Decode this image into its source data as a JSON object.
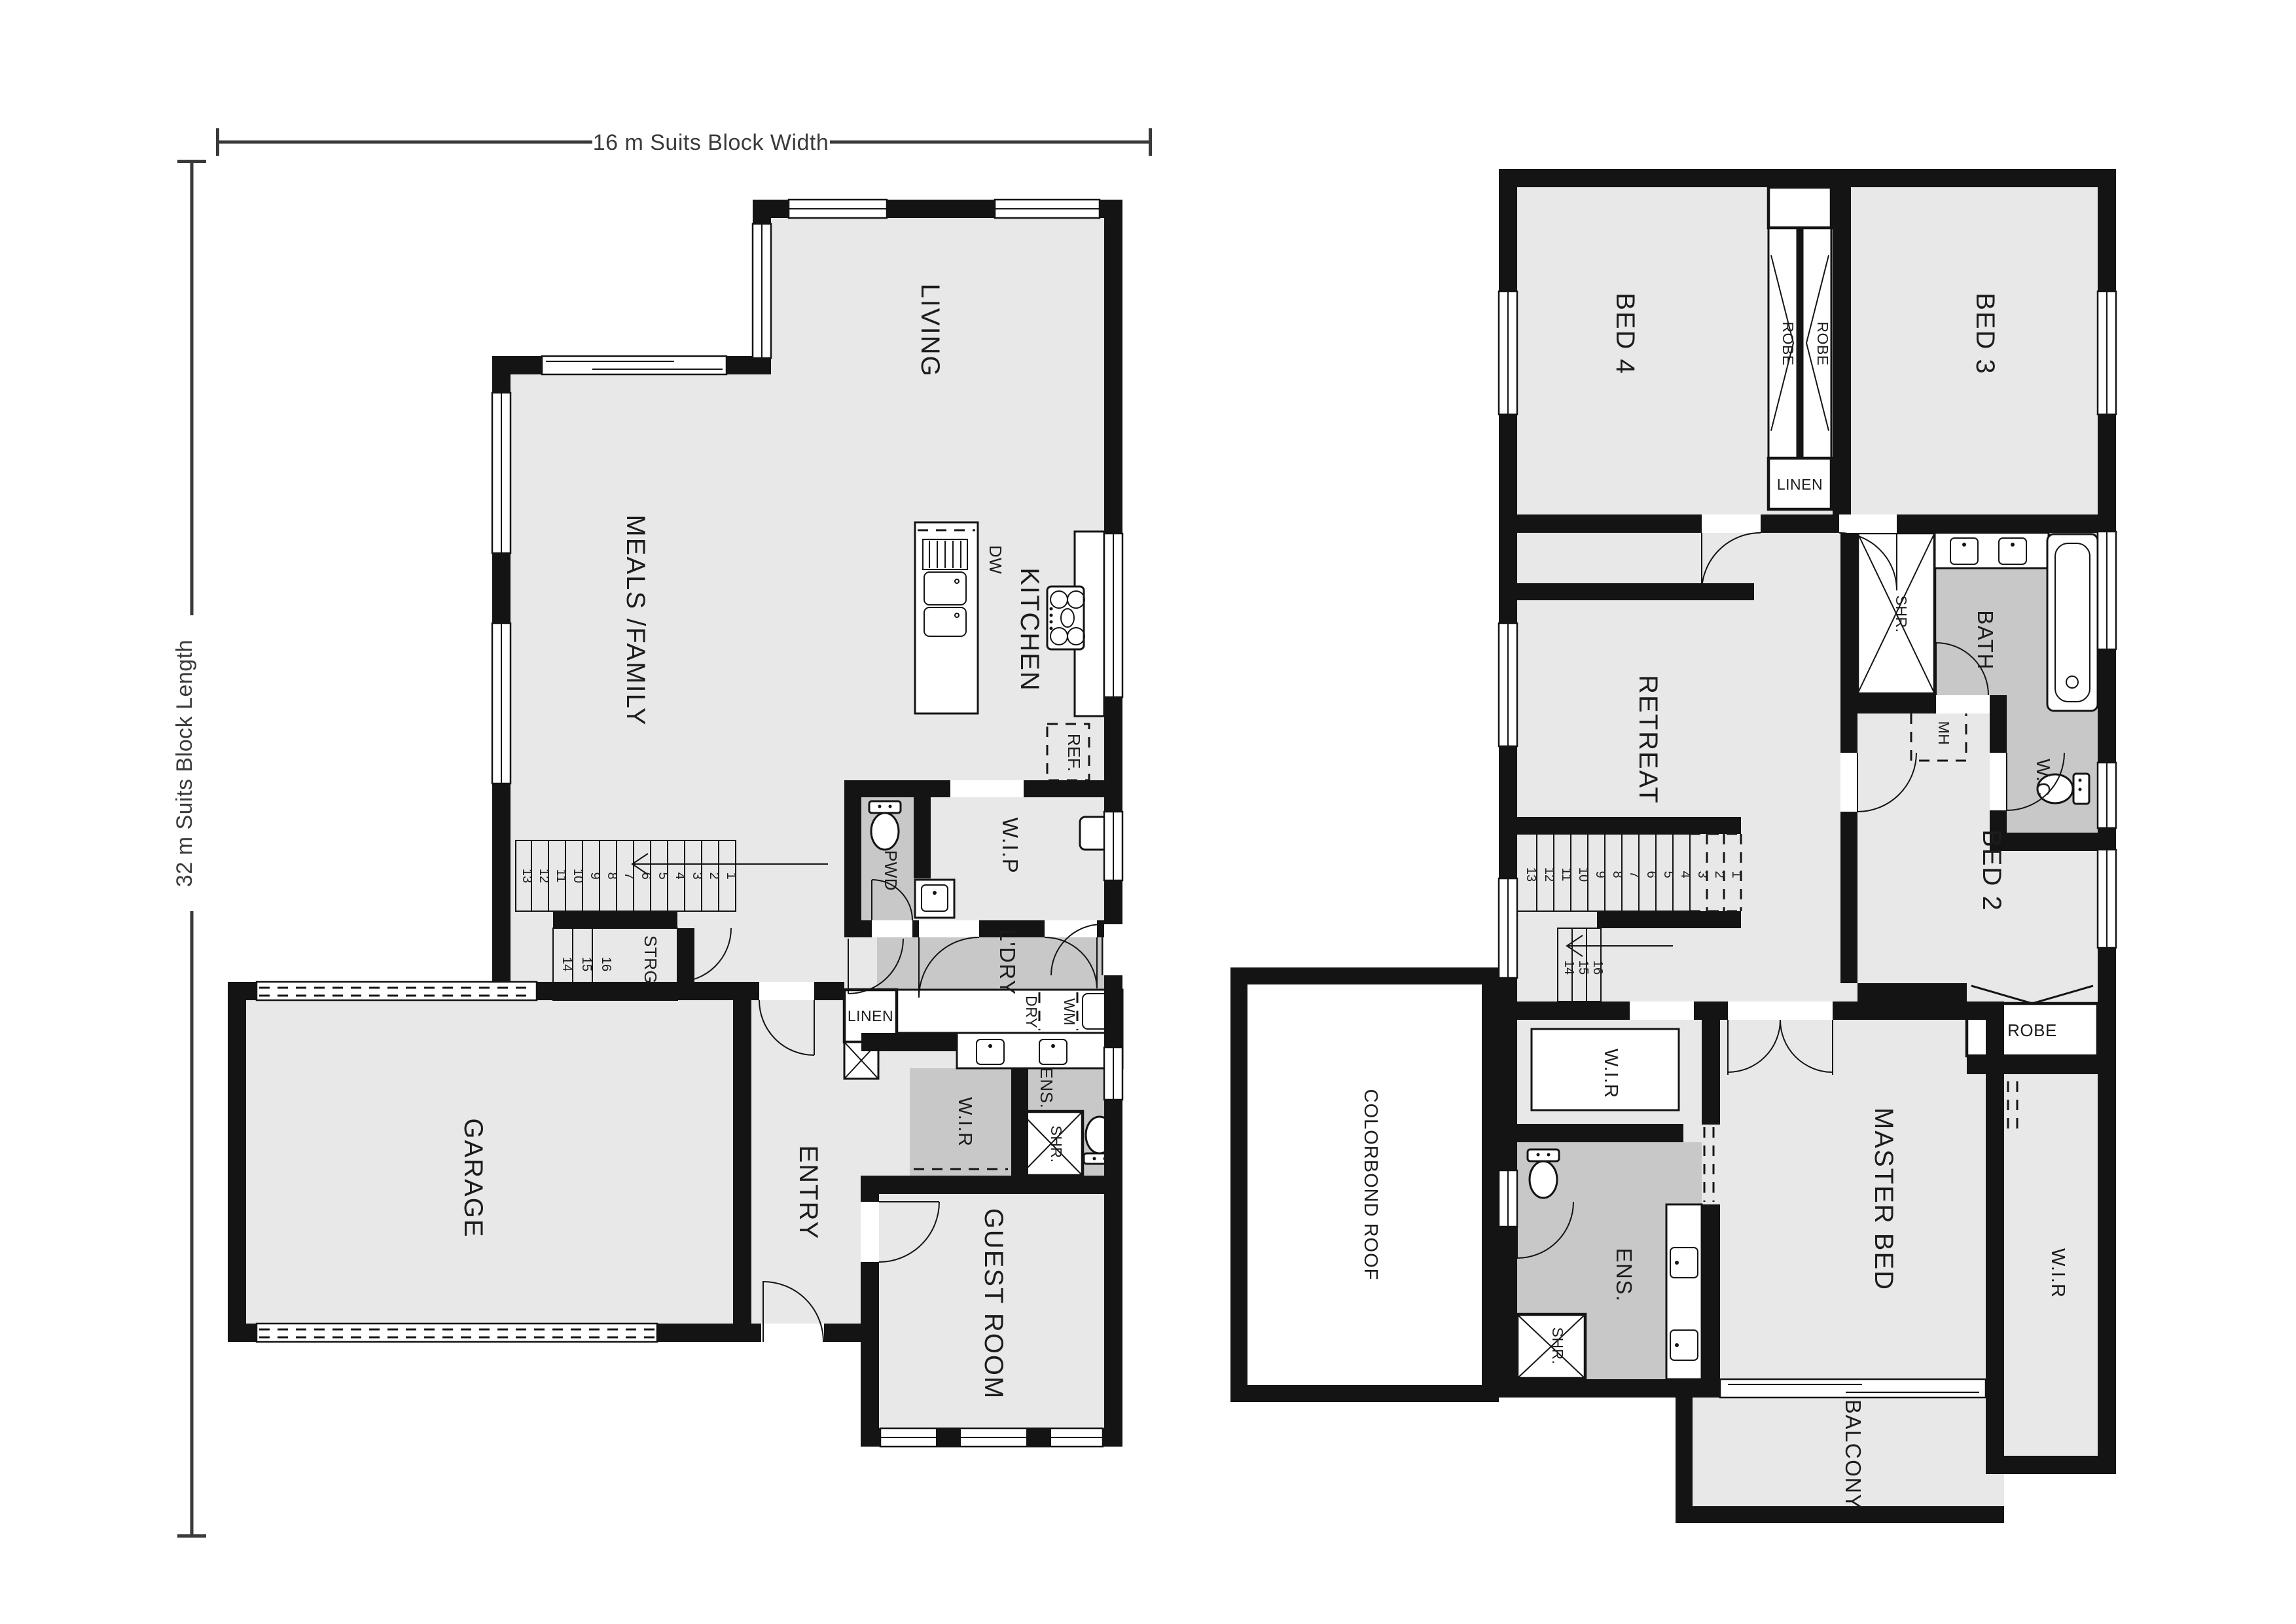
{
  "dimensions": {
    "width": "16 m Suits Block Width",
    "length": "32 m Suits Block Length"
  },
  "colors": {
    "wall": "#141414",
    "floor": "#e8e8e8",
    "wet_area": "#c8c8c8",
    "background": "#ffffff"
  },
  "ground": {
    "living": "LIVING",
    "meals": "MEALS /FAMILY",
    "kitchen": "KITCHEN",
    "dw": "DW",
    "ref": "REF.",
    "wip": "W.I.P",
    "pwd": "PWD",
    "strg": "STRG.",
    "ldry": "L'DRY",
    "linen": "LINEN",
    "dry": "DRY",
    "wm": "WM",
    "wir": "W.I.R",
    "ens": "ENS.",
    "shr": "SHR.",
    "guest": "GUEST ROOM",
    "entry": "ENTRY",
    "garage": "GARAGE",
    "stairs": [
      "1",
      "2",
      "3",
      "4",
      "5",
      "6",
      "7",
      "8",
      "9",
      "10",
      "11",
      "12",
      "13",
      "14",
      "15",
      "16"
    ]
  },
  "upper": {
    "bed4": "BED 4",
    "bed3": "BED 3",
    "robe_left": "ROBE",
    "robe_right": "ROBE",
    "linen": "LINEN",
    "retreat": "RETREAT",
    "bath": "BATH",
    "shr_bath": "SHR.",
    "mh": "MH",
    "wc": "W.C",
    "bed2": "BED 2",
    "robe_bed2": "ROBE",
    "wir_left": "W.I.R",
    "ens": "ENS.",
    "shr_ens": "SHR.",
    "master": "MASTER BED",
    "wir_right": "W.I.R",
    "balcony": "BALCONY",
    "roof": "COLORBOND ROOF",
    "stairs": [
      "1",
      "2",
      "3",
      "4",
      "5",
      "6",
      "7",
      "8",
      "9",
      "10",
      "11",
      "12",
      "13",
      "14",
      "15",
      "16"
    ]
  }
}
